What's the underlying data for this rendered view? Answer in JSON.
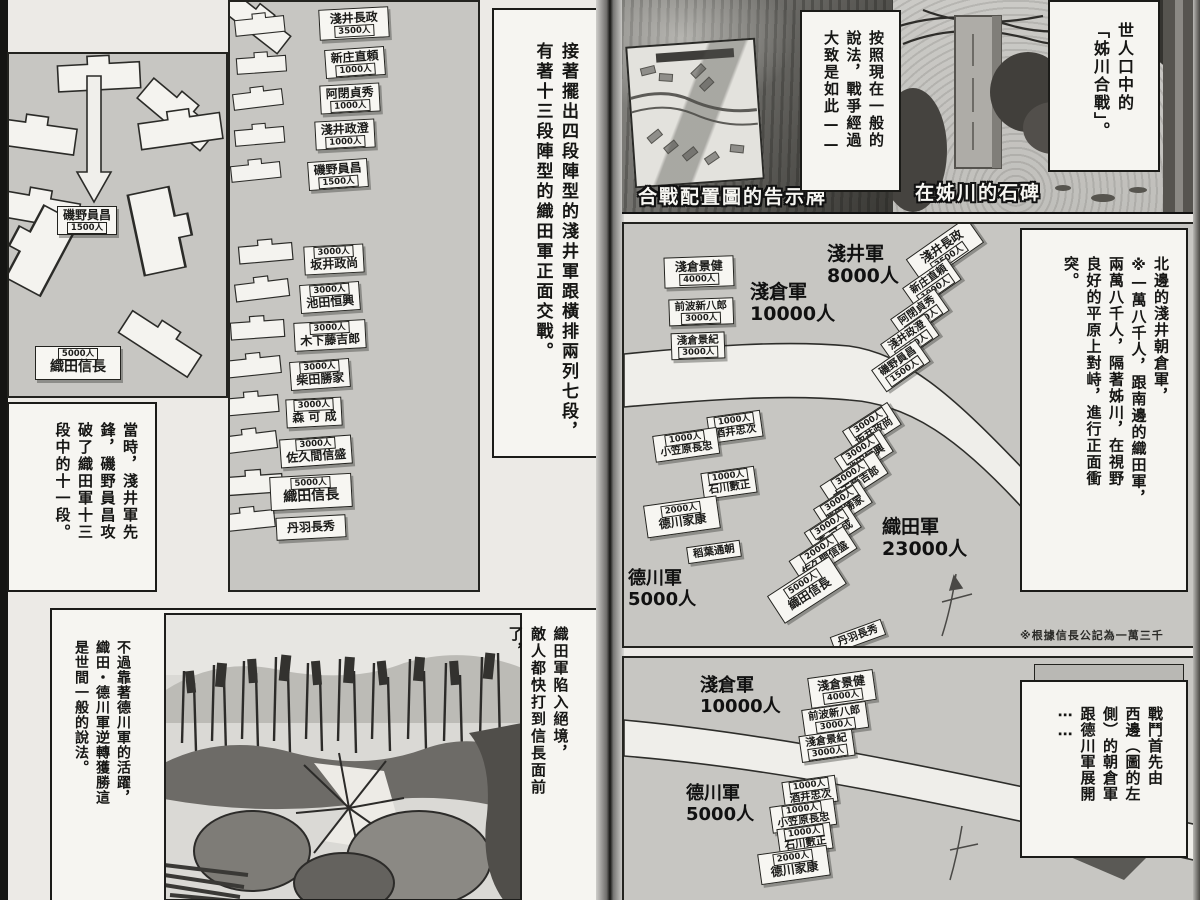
{
  "left_page": {
    "diagram": {
      "isono": {
        "name": "磯野員昌",
        "count": "1500人"
      },
      "nobunaga": {
        "name": "織田信長",
        "count": "5000人"
      }
    },
    "formation": {
      "asai_units": [
        {
          "name": "淺井長政",
          "count": "3500人"
        },
        {
          "name": "新庄直頼",
          "count": "1000人"
        },
        {
          "name": "阿閉貞秀",
          "count": "1000人"
        },
        {
          "name": "淺井政澄",
          "count": "1000人"
        },
        {
          "name": "磯野員昌",
          "count": "1500人"
        }
      ],
      "oda_units": [
        {
          "name": "坂井政尚",
          "count": "3000人"
        },
        {
          "name": "池田恒興",
          "count": "3000人"
        },
        {
          "name": "木下藤吉郎",
          "count": "3000人"
        },
        {
          "name": "柴田勝家",
          "count": "3000人"
        },
        {
          "name": "森 可 成",
          "count": "3000人"
        },
        {
          "name": "佐久間信盛",
          "count": "3000人"
        },
        {
          "name": "織田信長",
          "count": "5000人"
        },
        {
          "name": "丹羽長秀",
          "count": ""
        }
      ]
    },
    "narration_top": {
      "lines": [
        "接著擺出四段陣型的淺井軍跟橫排兩列七段，",
        "有著十三段陣型的織田軍正面交戰。"
      ]
    },
    "narration_left": {
      "lines": [
        "當時，淺井軍先",
        "鋒，磯野員昌攻",
        "破了織田軍十三",
        "段中的十一段。"
      ]
    },
    "narration_bottom_right": {
      "lines": [
        "織田軍陷入絕境，",
        "敵人都快打到信長面前",
        "了，"
      ]
    },
    "narration_bottom_left": {
      "lines": [
        "不過靠著德川軍的活躍，",
        "織田・德川軍逆轉獲勝這",
        "是世間一般的說法。"
      ]
    }
  },
  "right_page": {
    "photo_sign": {
      "caption": "合戰配置圖的告示牌"
    },
    "photo_stone": {
      "caption": "在姊川的石碑"
    },
    "speech_method": {
      "lines": [
        "按照現在一般的",
        "說法，戰爭經過",
        "大致是如此——"
      ]
    },
    "speech_title": {
      "lines": [
        "世人口中的",
        "「姊川合戰」。"
      ]
    },
    "main_map": {
      "armies": {
        "asakura": {
          "name": "淺倉軍",
          "count": "10000人"
        },
        "asai": {
          "name": "淺井軍",
          "count": "8000人"
        },
        "oda": {
          "name": "織田軍",
          "count": "23000人"
        },
        "tokugawa": {
          "name": "德川軍",
          "count": "5000人"
        }
      },
      "asakura_units": [
        {
          "name": "淺倉景健",
          "count": "4000人"
        },
        {
          "name": "前波新八郎",
          "count": "3000人"
        },
        {
          "name": "淺倉景紀",
          "count": "3000人"
        }
      ],
      "asai_units": [
        {
          "name": "淺井長政",
          "count": "3500人"
        },
        {
          "name": "新庄直頼",
          "count": "1000人"
        },
        {
          "name": "阿閉貞秀",
          "count": "1000人"
        },
        {
          "name": "淺井政澄",
          "count": "1000人"
        },
        {
          "name": "磯野員昌",
          "count": "1500人"
        }
      ],
      "tokugawa_units": [
        {
          "name": "酒井忠次",
          "count": "1000人"
        },
        {
          "name": "小笠原長忠",
          "count": "1000人"
        },
        {
          "name": "石川數正",
          "count": "1000人"
        },
        {
          "name": "德川家康",
          "count": "2000人"
        },
        {
          "name": "稻葉通朝",
          "count": ""
        }
      ],
      "oda_units": [
        {
          "name": "坂井政尚",
          "count": "3000人"
        },
        {
          "name": "池田恒興",
          "count": "3000人"
        },
        {
          "name": "木下藤吉郎",
          "count": "3000人"
        },
        {
          "name": "柴田勝家",
          "count": "3000人"
        },
        {
          "name": "森 可 成",
          "count": "3000人"
        },
        {
          "name": "佐久間信盛",
          "count": "2000人"
        },
        {
          "name": "織田信長",
          "count": "5000人"
        },
        {
          "name": "丹羽長秀",
          "count": ""
        }
      ]
    },
    "note": "※根據信長公記為一萬三千",
    "narration_map": {
      "lines": [
        "北邊的淺井朝倉軍，",
        "※一萬八千人，跟南邊的織田軍，",
        "兩萬八千人，隔著姊川，在視野",
        "良好的平原上對峙，進行正面衝",
        "突。"
      ]
    },
    "bottom_map": {
      "asakura_army": {
        "name": "淺倉軍",
        "count": "10000人"
      },
      "tokugawa_army": {
        "name": "德川軍",
        "count": "5000人"
      },
      "asakura_units": [
        {
          "name": "淺倉景健",
          "count": "4000人"
        },
        {
          "name": "前波新八郎",
          "count": "3000人"
        },
        {
          "name": "淺倉景紀",
          "count": "3000人"
        }
      ],
      "tokugawa_units": [
        {
          "name": "酒井忠次",
          "count": "1000人"
        },
        {
          "name": "小笠原長忠",
          "count": "1000人"
        },
        {
          "name": "石川數正",
          "count": "1000人"
        },
        {
          "name": "德川家康",
          "count": "2000人"
        }
      ]
    },
    "narration_battle_start": {
      "lines": [
        "戰鬥首先由",
        "西邊（圖的左",
        "側）的朝倉軍",
        "跟德川軍展開",
        "⋯⋯"
      ]
    }
  }
}
